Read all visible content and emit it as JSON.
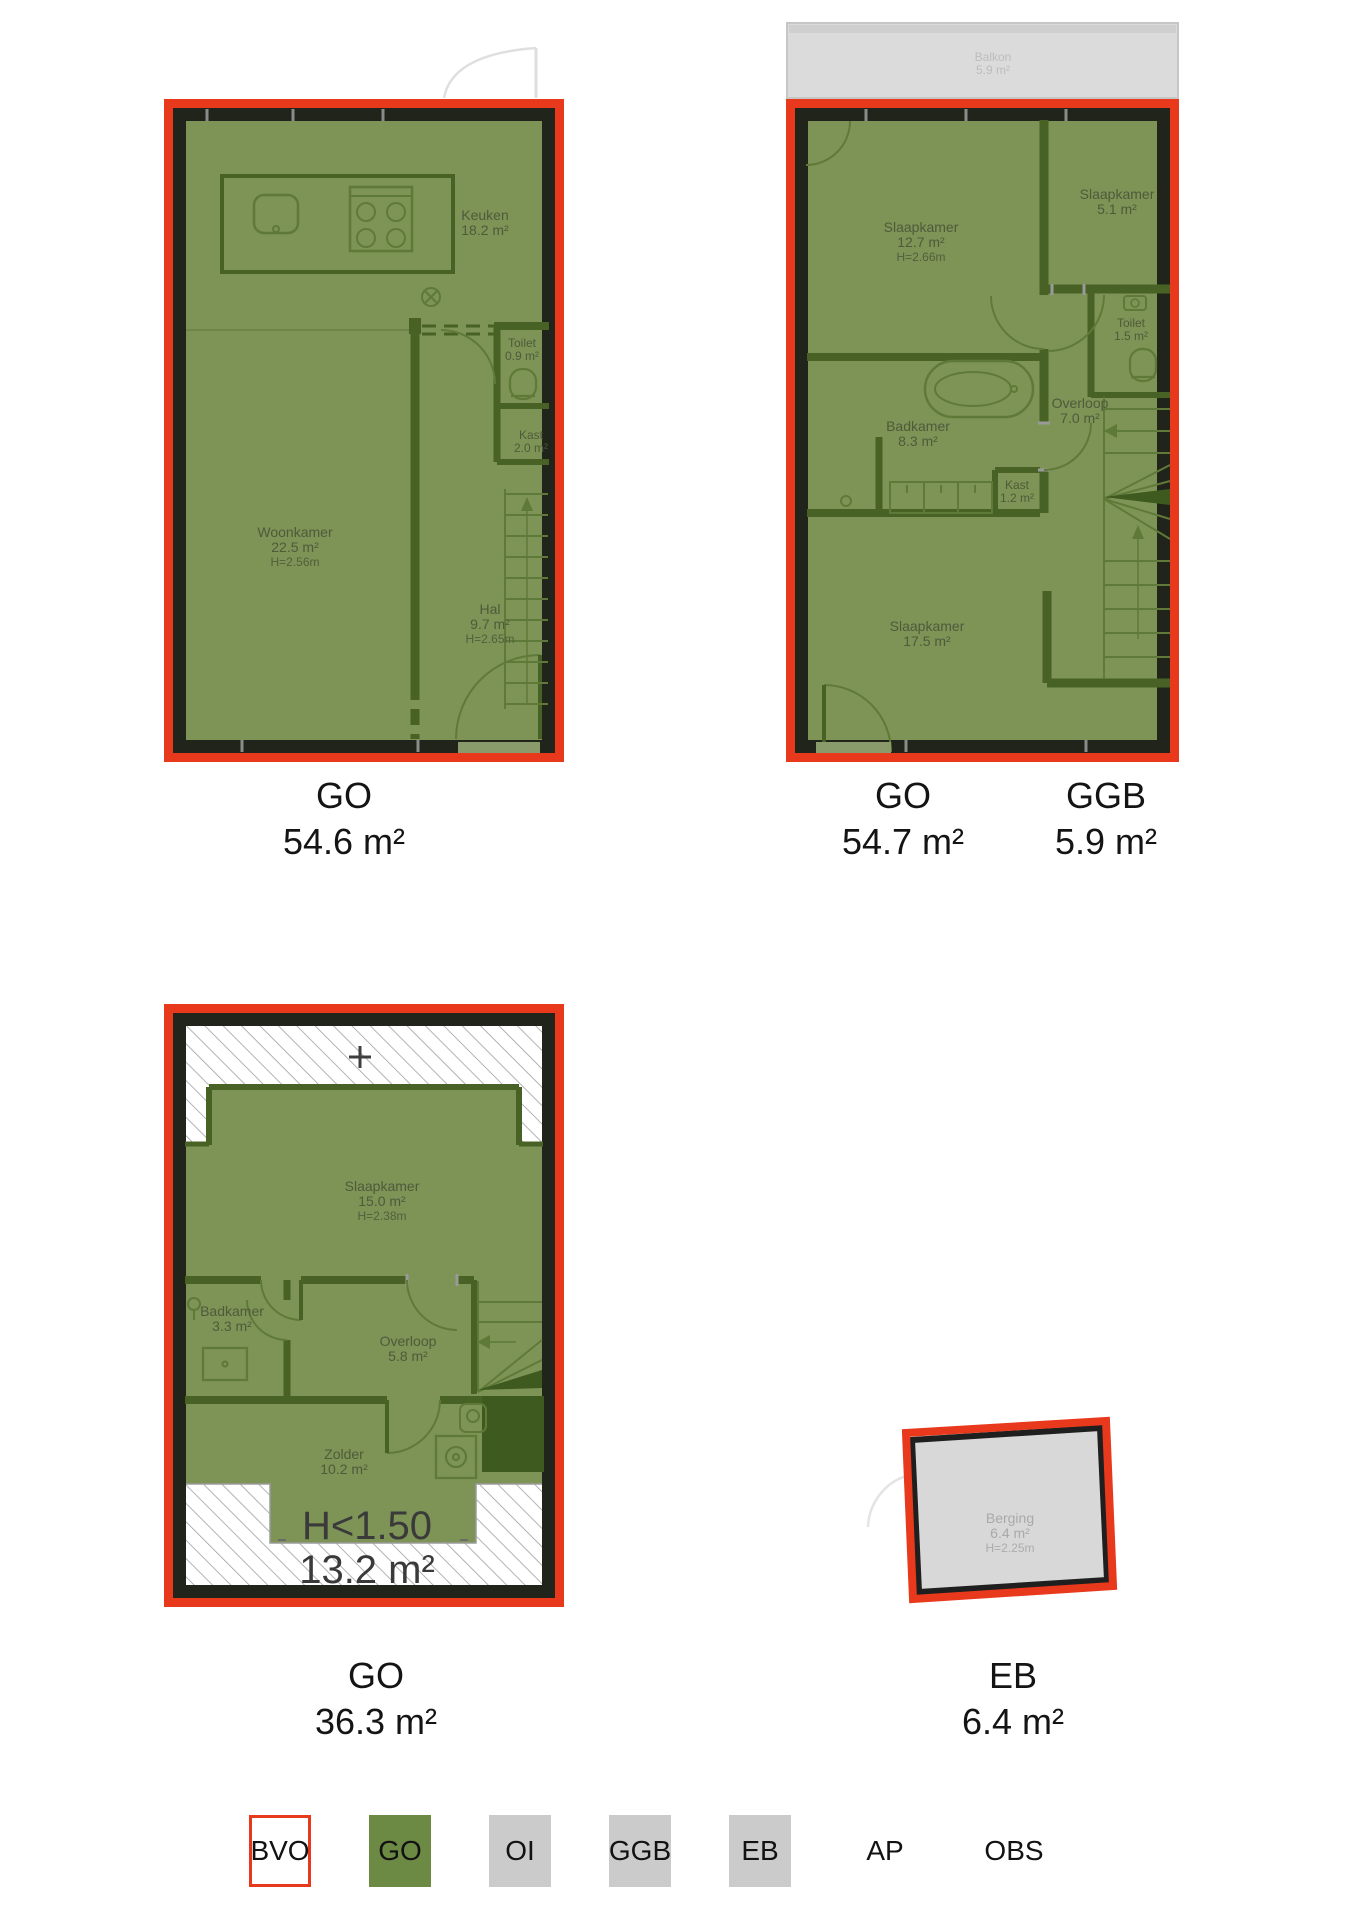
{
  "floor1": {
    "rooms": {
      "keuken": {
        "name": "Keuken",
        "area": "18.2 m²"
      },
      "toilet": {
        "name": "Toilet",
        "area": "0.9 m²"
      },
      "kast": {
        "name": "Kast",
        "area": "2.0 m²"
      },
      "woonkamer": {
        "name": "Woonkamer",
        "area": "22.5 m²",
        "ceiling": "H=2.56m"
      },
      "hal": {
        "name": "Hal",
        "area": "9.7 m²",
        "ceiling": "H=2.65m"
      }
    },
    "caption": {
      "code": "GO",
      "area": "54.6 m²"
    }
  },
  "floor2": {
    "balkon": {
      "name": "Balkon",
      "area": "5.9 m²"
    },
    "rooms": {
      "slaapkamer1": {
        "name": "Slaapkamer",
        "area": "12.7 m²",
        "ceiling": "H=2.66m"
      },
      "slaapkamer2": {
        "name": "Slaapkamer",
        "area": "5.1 m²"
      },
      "toilet": {
        "name": "Toilet",
        "area": "1.5 m²"
      },
      "overloop": {
        "name": "Overloop",
        "area": "7.0 m²"
      },
      "badkamer": {
        "name": "Badkamer",
        "area": "8.3 m²"
      },
      "kast": {
        "name": "Kast",
        "area": "1.2 m²"
      },
      "slaapkamer3": {
        "name": "Slaapkamer",
        "area": "17.5 m²"
      }
    },
    "caption_go": {
      "code": "GO",
      "area": "54.7 m²"
    },
    "caption_ggb": {
      "code": "GGB",
      "area": "5.9 m²"
    }
  },
  "floor3": {
    "rooms": {
      "slaapkamer": {
        "name": "Slaapkamer",
        "area": "15.0 m²",
        "ceiling": "H=2.38m"
      },
      "badkamer": {
        "name": "Badkamer",
        "area": "3.3 m²"
      },
      "overloop": {
        "name": "Overloop",
        "area": "5.8 m²"
      },
      "zolder": {
        "name": "Zolder",
        "area": "10.2 m²"
      }
    },
    "low_headroom": {
      "label": "H<1.50",
      "area": "13.2 m²"
    },
    "caption": {
      "code": "GO",
      "area": "36.3 m²"
    }
  },
  "berging": {
    "room": {
      "name": "Berging",
      "area": "6.4 m²",
      "ceiling": "H=2.25m"
    },
    "caption": {
      "code": "EB",
      "area": "6.4 m²"
    }
  },
  "legend": {
    "items": [
      {
        "label": "BVO",
        "style": "bvo"
      },
      {
        "label": "GO",
        "style": "go"
      },
      {
        "label": "OI",
        "style": "gray"
      },
      {
        "label": "GGB",
        "style": "gray"
      },
      {
        "label": "EB",
        "style": "gray"
      },
      {
        "label": "AP",
        "style": "plain"
      },
      {
        "label": "OBS",
        "style": "plain"
      }
    ]
  },
  "colors": {
    "outline_red": "#E8391D",
    "floor_green": "#7E9356",
    "wall_green": "#486226",
    "legend_green": "#6C8A43",
    "legend_gray": "#CBCBCB",
    "surface_gray": "#DBDBDB"
  }
}
